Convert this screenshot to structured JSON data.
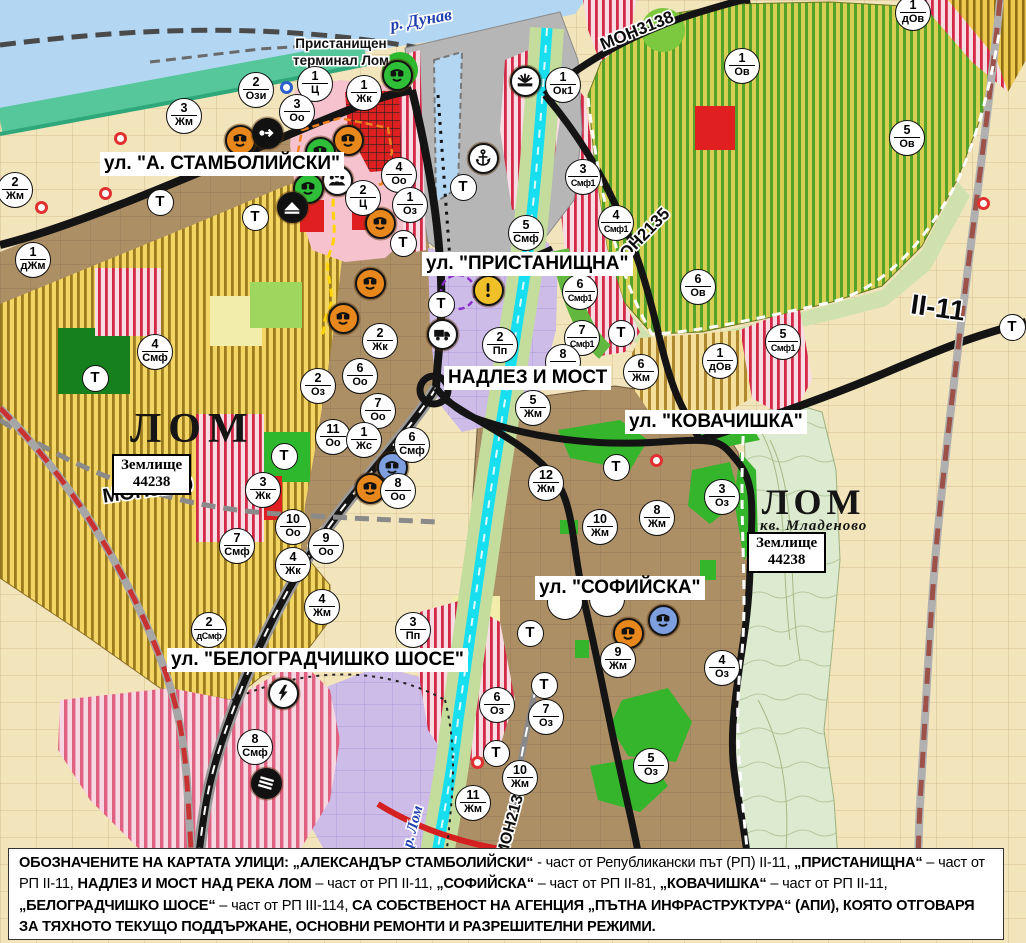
{
  "map": {
    "water_label": {
      "text": "р. Дунав"
    },
    "river_label": {
      "text": "р. Лом"
    },
    "port_label": {
      "lines": [
        "Пристанищен",
        "терминал Лом"
      ]
    },
    "city_labels": [
      {
        "name": "ЛОМ"
      },
      {
        "name": "ЛОМ",
        "sub": "кв. Младеново"
      }
    ],
    "land_plates": [
      {
        "lines": [
          "Землище",
          "44238"
        ]
      },
      {
        "lines": [
          "Землище",
          "44238"
        ]
      }
    ],
    "road_labels": [
      {
        "text": "МОН3138",
        "x": 637,
        "y": 31,
        "angle": -22,
        "size": 17
      },
      {
        "text": "МОН2135",
        "x": 640,
        "y": 239,
        "angle": -46,
        "size": 17
      },
      {
        "text": "МОН3139",
        "x": 148,
        "y": 491,
        "angle": -8,
        "size": 20
      },
      {
        "text": "МОН2136",
        "x": 512,
        "y": 822,
        "angle": -75,
        "size": 16
      },
      {
        "text": "II-11",
        "x": 938,
        "y": 308,
        "angle": 8,
        "size": 28
      }
    ],
    "street_labels": [
      {
        "text": "ул. \"А. СТАМБОЛИЙСКИ\"",
        "x": 100,
        "y": 152
      },
      {
        "text": "ул. \"ПРИСТАНИЩНА\"",
        "x": 422,
        "y": 252
      },
      {
        "text": "НАДЛЕЗ И МОСТ",
        "x": 444,
        "y": 366
      },
      {
        "text": "ул. \"КОВАЧИШКА\"",
        "x": 625,
        "y": 410
      },
      {
        "text": "ул. \"СОФИЙСКА\"",
        "x": 535,
        "y": 576
      },
      {
        "text": "ул. \"БЕЛОГРАДЧИШКО ШОСЕ\"",
        "x": 167,
        "y": 648
      }
    ],
    "zone_markers": [
      {
        "n": "2",
        "c": "Ози",
        "x": 256,
        "y": 90
      },
      {
        "n": "1",
        "c": "Ц",
        "x": 315,
        "y": 84
      },
      {
        "n": "1",
        "c": "Жк",
        "x": 364,
        "y": 93
      },
      {
        "n": "3",
        "c": "Оо",
        "x": 297,
        "y": 112
      },
      {
        "n": "3",
        "c": "Жм",
        "x": 184,
        "y": 116
      },
      {
        "n": "2",
        "c": "Жм",
        "x": 15,
        "y": 190
      },
      {
        "n": "1",
        "c": "дЖм",
        "x": 33,
        "y": 260
      },
      {
        "n": "4",
        "c": "Оо",
        "x": 399,
        "y": 175
      },
      {
        "n": "2",
        "c": "Ц",
        "x": 363,
        "y": 198
      },
      {
        "n": "1",
        "c": "Оз",
        "x": 410,
        "y": 205
      },
      {
        "n": "1",
        "c": "Ок1",
        "x": 563,
        "y": 85
      },
      {
        "n": "3",
        "c": "Смф1",
        "x": 583,
        "y": 177
      },
      {
        "n": "5",
        "c": "Смф",
        "x": 526,
        "y": 233
      },
      {
        "n": "4",
        "c": "Смф1",
        "x": 616,
        "y": 223
      },
      {
        "n": "6",
        "c": "Смф1",
        "x": 580,
        "y": 292
      },
      {
        "n": "7",
        "c": "Смф1",
        "x": 582,
        "y": 338
      },
      {
        "n": "2",
        "c": "Пп",
        "x": 500,
        "y": 345
      },
      {
        "n": "8",
        "c": "",
        "x": 563,
        "y": 362
      },
      {
        "n": "5",
        "c": "Жм",
        "x": 533,
        "y": 408
      },
      {
        "n": "1",
        "c": "Ов",
        "x": 742,
        "y": 66
      },
      {
        "n": "5",
        "c": "Ов",
        "x": 907,
        "y": 138
      },
      {
        "n": "1",
        "c": "дОв",
        "x": 913,
        "y": 13
      },
      {
        "n": "6",
        "c": "Ов",
        "x": 698,
        "y": 287
      },
      {
        "n": "1",
        "c": "дОв",
        "x": 720,
        "y": 361
      },
      {
        "n": "5",
        "c": "Смф1",
        "x": 783,
        "y": 342
      },
      {
        "n": "6",
        "c": "Жм",
        "x": 641,
        "y": 372
      },
      {
        "n": "2",
        "c": "Жк",
        "x": 380,
        "y": 341
      },
      {
        "n": "6",
        "c": "Оо",
        "x": 360,
        "y": 376
      },
      {
        "n": "7",
        "c": "Оо",
        "x": 378,
        "y": 411
      },
      {
        "n": "2",
        "c": "Оз",
        "x": 318,
        "y": 386
      },
      {
        "n": "11",
        "c": "Оо",
        "x": 333,
        "y": 437
      },
      {
        "n": "1",
        "c": "Жс",
        "x": 364,
        "y": 440
      },
      {
        "n": "6",
        "c": "Смф",
        "x": 412,
        "y": 445
      },
      {
        "n": "8",
        "c": "Оо",
        "x": 398,
        "y": 491
      },
      {
        "n": "3",
        "c": "Жк",
        "x": 263,
        "y": 490
      },
      {
        "n": "10",
        "c": "Оо",
        "x": 293,
        "y": 527
      },
      {
        "n": "9",
        "c": "Оо",
        "x": 326,
        "y": 546
      },
      {
        "n": "4",
        "c": "Жк",
        "x": 293,
        "y": 565
      },
      {
        "n": "7",
        "c": "Смф",
        "x": 237,
        "y": 546
      },
      {
        "n": "4",
        "c": "Смф",
        "x": 155,
        "y": 352
      },
      {
        "n": "4",
        "c": "Жм",
        "x": 322,
        "y": 607
      },
      {
        "n": "2",
        "c": "дСмф",
        "x": 209,
        "y": 630
      },
      {
        "n": "3",
        "c": "Пп",
        "x": 413,
        "y": 630
      },
      {
        "n": "8",
        "c": "Смф",
        "x": 255,
        "y": 747
      },
      {
        "n": "12",
        "c": "Жм",
        "x": 546,
        "y": 483
      },
      {
        "n": "10",
        "c": "Жм",
        "x": 600,
        "y": 527
      },
      {
        "n": "8",
        "c": "Жм",
        "x": 657,
        "y": 518
      },
      {
        "n": "3",
        "c": "Оз",
        "x": 722,
        "y": 497
      },
      {
        "n": "9",
        "c": "Жм",
        "x": 618,
        "y": 660
      },
      {
        "n": "4",
        "c": "Оз",
        "x": 722,
        "y": 668
      },
      {
        "n": "6",
        "c": "Оз",
        "x": 497,
        "y": 705
      },
      {
        "n": "7",
        "c": "Оз",
        "x": 546,
        "y": 717
      },
      {
        "n": "5",
        "c": "Оз",
        "x": 651,
        "y": 766
      },
      {
        "n": "10",
        "c": "Жм",
        "x": 520,
        "y": 778
      },
      {
        "n": "11",
        "c": "Жм",
        "x": 473,
        "y": 803
      },
      {
        "n": "",
        "c": "Оз",
        "x": 565,
        "y": 602
      },
      {
        "n": "",
        "c": "Оз",
        "x": 607,
        "y": 599
      }
    ],
    "t_markers": [
      {
        "label": "Т",
        "x": 160,
        "y": 202
      },
      {
        "label": "Т",
        "x": 255,
        "y": 217
      },
      {
        "label": "Т",
        "x": 403,
        "y": 243
      },
      {
        "label": "Т",
        "x": 441,
        "y": 304
      },
      {
        "label": "Т",
        "x": 463,
        "y": 187
      },
      {
        "label": "Т",
        "x": 95,
        "y": 378
      },
      {
        "label": "Т",
        "x": 284,
        "y": 456
      },
      {
        "label": "Т",
        "x": 621,
        "y": 333
      },
      {
        "label": "Т",
        "x": 616,
        "y": 467
      },
      {
        "label": "Т",
        "x": 530,
        "y": 633
      },
      {
        "label": "Т",
        "x": 544,
        "y": 685
      },
      {
        "label": "Т",
        "x": 496,
        "y": 753
      },
      {
        "label": "Т",
        "x": 1012,
        "y": 327
      }
    ],
    "icon_markers": [
      {
        "icon": "monument-icon",
        "bg": "#2fbe37",
        "x": 397,
        "y": 75
      },
      {
        "icon": "monument-icon",
        "bg": "#e8881c",
        "x": 240,
        "y": 140
      },
      {
        "icon": "one-way-arrow-icon",
        "bg": "#111111",
        "x": 267,
        "y": 133
      },
      {
        "icon": "monument-icon",
        "bg": "#e8881c",
        "x": 348,
        "y": 140
      },
      {
        "icon": "monument-icon",
        "bg": "#2fbe37",
        "x": 320,
        "y": 152
      },
      {
        "icon": "people-icon",
        "bg": "#ffffff",
        "x": 337,
        "y": 180
      },
      {
        "icon": "monument-icon",
        "bg": "#2fbe37",
        "x": 308,
        "y": 188
      },
      {
        "icon": "mound-icon",
        "bg": "#111111",
        "x": 292,
        "y": 207
      },
      {
        "icon": "monument-icon",
        "bg": "#e8881c",
        "x": 380,
        "y": 223
      },
      {
        "icon": "monument-icon",
        "bg": "#e8881c",
        "x": 370,
        "y": 283
      },
      {
        "icon": "monument-icon",
        "bg": "#e8881c",
        "x": 343,
        "y": 318
      },
      {
        "icon": "monument-icon",
        "bg": "#7d9fe0",
        "x": 392,
        "y": 467
      },
      {
        "icon": "monument-icon",
        "bg": "#e8881c",
        "x": 370,
        "y": 488
      },
      {
        "icon": "truck-icon",
        "bg": "#ffffff",
        "x": 442,
        "y": 334
      },
      {
        "icon": "warning-icon",
        "bg": "#f0c028",
        "x": 488,
        "y": 290
      },
      {
        "icon": "anchor-icon",
        "bg": "#ffffff",
        "x": 483,
        "y": 158
      },
      {
        "icon": "harbor-light-icon",
        "bg": "#ffffff",
        "x": 525,
        "y": 81
      },
      {
        "icon": "power-icon",
        "bg": "#ffffff",
        "x": 283,
        "y": 693
      },
      {
        "icon": "railway-icon",
        "bg": "#111111",
        "x": 266,
        "y": 783
      },
      {
        "icon": "monument-icon",
        "bg": "#e8881c",
        "x": 628,
        "y": 633
      },
      {
        "icon": "monument-icon",
        "bg": "#7d9fe0",
        "x": 663,
        "y": 620
      }
    ],
    "dot_markers": [
      {
        "x": 120,
        "y": 138,
        "color": "#e03030"
      },
      {
        "x": 105,
        "y": 193,
        "color": "#e03030"
      },
      {
        "x": 41,
        "y": 207,
        "color": "#e03030"
      },
      {
        "x": 656,
        "y": 460,
        "color": "#e03030"
      },
      {
        "x": 477,
        "y": 762,
        "color": "#e03030"
      },
      {
        "x": 983,
        "y": 203,
        "color": "#e03030"
      },
      {
        "x": 286,
        "y": 87,
        "color": "#2b5fd0"
      }
    ]
  },
  "footer": {
    "runs": [
      {
        "bold": true,
        "text": "ОБОЗНАЧЕНИТЕ НА КАРТАТА УЛИЦИ: „АЛЕКСАНДЪР СТАМБОЛИЙСКИ“"
      },
      {
        "bold": false,
        "text": " - част от Републикански път (РП) II-11, "
      },
      {
        "bold": true,
        "text": "„ПРИСТАНИЩНА“"
      },
      {
        "bold": false,
        "text": " – част от РП II-11, "
      },
      {
        "bold": true,
        "text": "НАДЛЕЗ И МОСТ НАД РЕКА ЛОМ"
      },
      {
        "bold": false,
        "text": " – част от РП II-11, "
      },
      {
        "bold": true,
        "text": "„СОФИЙСКА“"
      },
      {
        "bold": false,
        "text": " – част от РП II-81, "
      },
      {
        "bold": true,
        "text": "„КОВАЧИШКА“"
      },
      {
        "bold": false,
        "text": " – част от РП II-11, "
      },
      {
        "bold": true,
        "text": "„БЕЛОГРАДЧИШКО ШОСЕ“"
      },
      {
        "bold": false,
        "text": " – част от РП III-114, "
      },
      {
        "bold": true,
        "text": "СА СОБСТВЕНОСТ НА АГЕНЦИЯ „ПЪТНА ИНФРАСТРУКТУРА“ (АПИ), КОЯТО ОТГОВАРЯ ЗА ТЯХНОТО ТЕКУЩО ПОДДЪРЖАНЕ, ОСНОВНИ РЕМОНТИ И РАЗРЕШИТЕЛНИ РЕЖИМИ."
      }
    ]
  }
}
